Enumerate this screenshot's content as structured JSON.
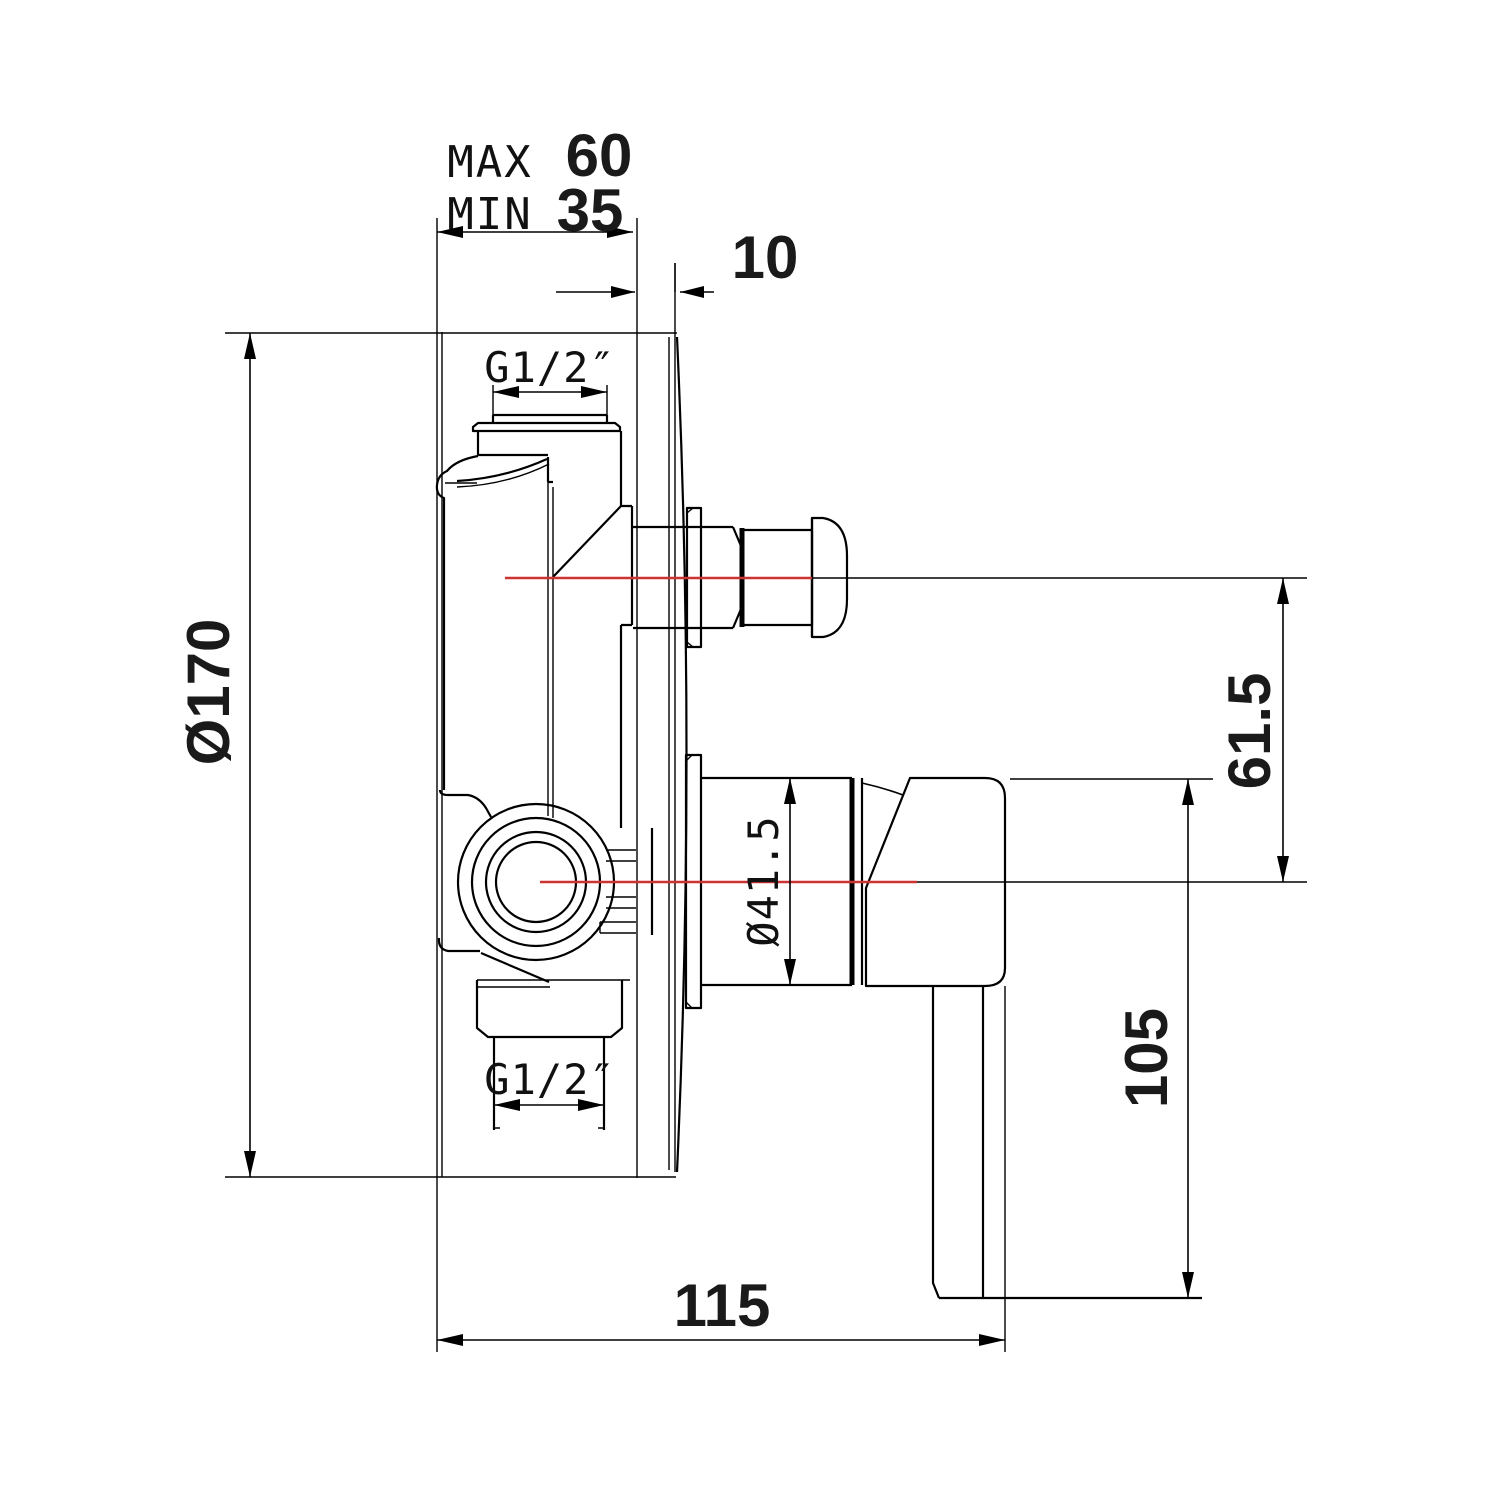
{
  "drawing": {
    "title": "Concealed shower mixer valve side installation drawing",
    "colors": {
      "line": "#000000",
      "centerline": "#cc3333",
      "background": "#ffffff",
      "text": "#1a1a1a"
    },
    "dimensions": {
      "embed_depth_max_label": "MAX",
      "embed_depth_max": "60",
      "embed_depth_min_label": "MIN",
      "embed_depth_min": "35",
      "plate_offset": "10",
      "plate_diameter": "Ø170",
      "inlet_thread_top": "G1/2″",
      "outlet_thread_bottom": "G1/2″",
      "diverter_to_handle_axis": "61.5",
      "trim_sleeve_diameter": "Ø41.5",
      "handle_length": "105",
      "overall_depth": "115"
    }
  }
}
